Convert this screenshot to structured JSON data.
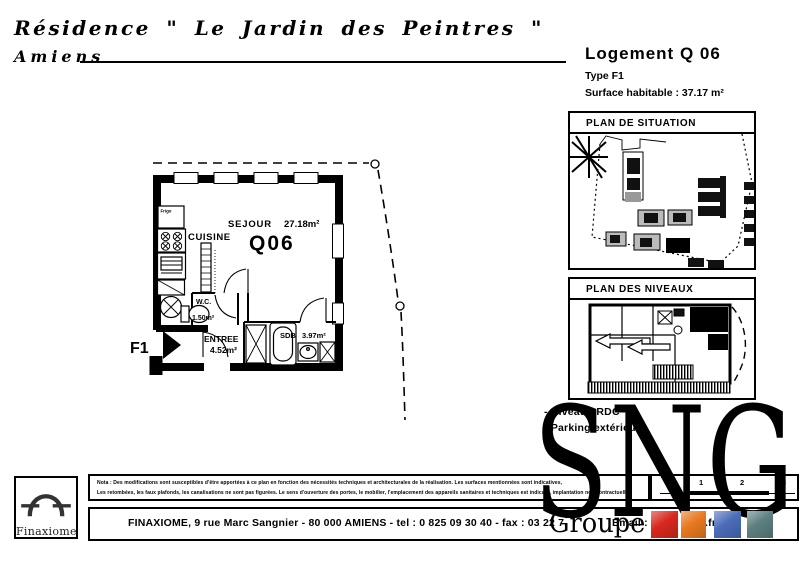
{
  "project": {
    "residence": "Résidence \" Le Jardin des Peintres \"",
    "city": "Amiens"
  },
  "unit": {
    "title": "Logement Q 06",
    "type": "Type F1",
    "surface": "Surface habitable : 37.17 m²",
    "code": "Q06",
    "marker": "F1"
  },
  "panels": {
    "situation": "PLAN DE SITUATION",
    "niveaux": "PLAN DES NIVEAUX"
  },
  "details": {
    "niveau": "- Niveau : RDC",
    "parking": "- Parking extérieur"
  },
  "rooms": {
    "sejour": {
      "name": "SEJOUR",
      "area": "27.18m²"
    },
    "cuisine": {
      "name": "CUISINE"
    },
    "wc": {
      "name": "W.C.",
      "area": "1.50m²"
    },
    "entree": {
      "name": "ENTREE",
      "area": "4.52m²"
    },
    "sdb": {
      "name": "SDB",
      "area": "3.97m²"
    },
    "frigo": "Frigo"
  },
  "brand": {
    "sng": "SNG",
    "groupe": "Groupe",
    "finaxiome": "Finaxiome"
  },
  "scalebar": {
    "t1": "1",
    "t2": "2",
    "t3": "3"
  },
  "disclaimer": {
    "line1": "Nota : Des modifications sont susceptibles d'être apportées à ce plan en fonction des nécessités techniques et architecturales de la réalisation.   Les surfaces mentionnées sont indicatives,",
    "line2": "Les retombées, les faux plafonds, les canalisations ne sont pas figurées.   Le sens d'ouverture des portes, le mobilier, l'emplacement des appareils sanitaires et techniques est indicatif, implantation non contractuelle"
  },
  "footer": {
    "part1": "FINAXIOME, 9 rue Marc Sangnier - 80 000 AMIENS  -  tel : 0 825 09 30 40  -  fax : 03 22 7",
    "part2": "Email : Info",
    "part3": ".fr"
  },
  "colors": {
    "red": "#d7281d",
    "orange": "#e8791f",
    "blue": "#4a6cb8",
    "teal": "#5d7f7f"
  }
}
